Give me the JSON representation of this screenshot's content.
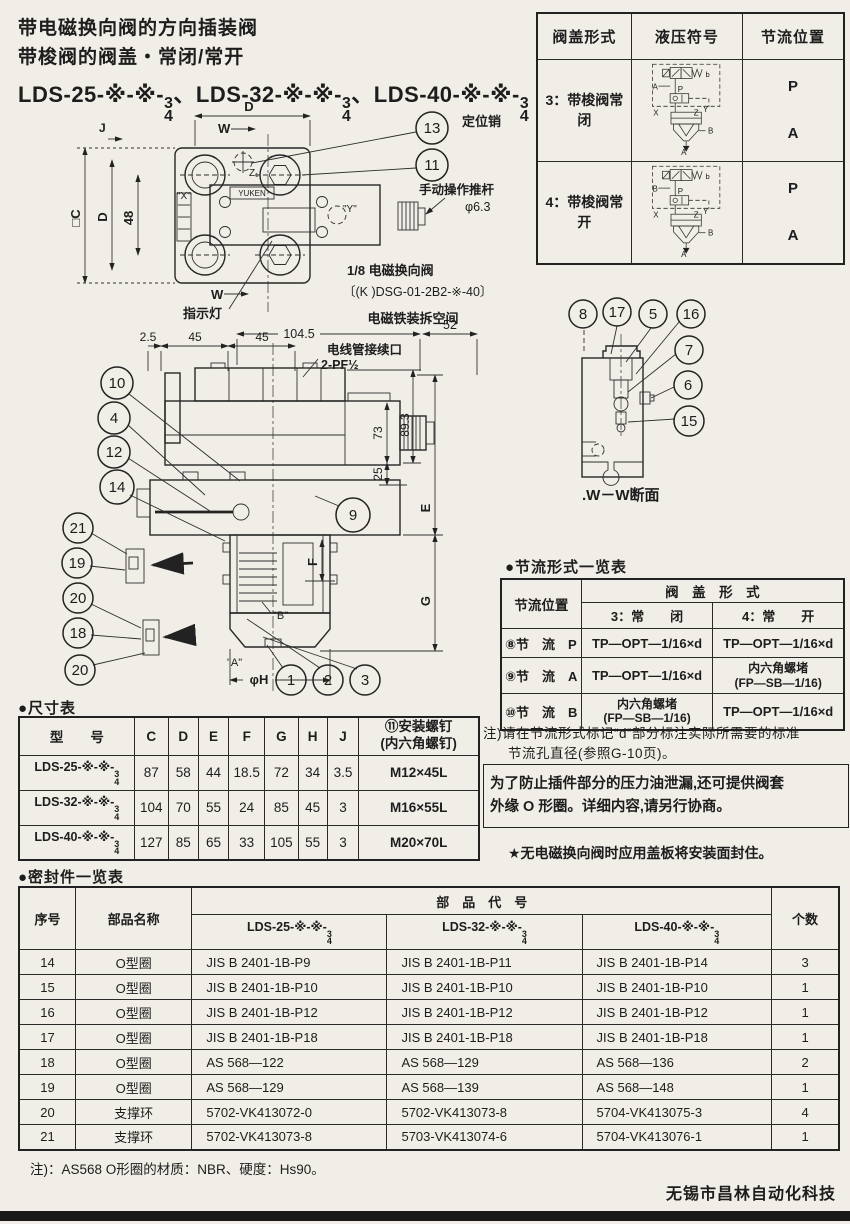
{
  "page": {
    "title_line1": "带电磁换向阀的方向插装阀",
    "title_line2": "带梭阀的阀盖・常闭/常开",
    "model_line": {
      "m1": "LDS-25-※-※-",
      "m2": "、LDS-32-※-※-",
      "m3": "、LDS-40-※-※-"
    },
    "frac": {
      "n": "3",
      "d": "4"
    },
    "footer": "无锡市昌林自动化科技"
  },
  "cover_table": {
    "h_form": "阀盖形式",
    "h_symbol": "液压符号",
    "h_throttle": "节流位置",
    "rows": [
      {
        "form": "3：带梭阀常闭",
        "p": "P",
        "a": "A",
        "sym": {
          "left": "A",
          "p": "P",
          "b": "b",
          "x": "X",
          "z": "Z",
          "y": "Y",
          "bport": "B",
          "abot": "A"
        }
      },
      {
        "form": "4：带梭阀常开",
        "p": "P",
        "a": "A",
        "sym": {
          "left": "B",
          "p": "P",
          "b": "b",
          "x": "X",
          "z": "Z",
          "y": "Y",
          "bport": "B",
          "abot": "A"
        }
      }
    ]
  },
  "top_view": {
    "balloon_13": "13",
    "balloon_11": "11",
    "pin_label": "定位销",
    "rod_label": "手动操作推杆",
    "rod_dia": "φ6.3",
    "sol_label1": "1/8 电磁换向阀",
    "sol_label2": "〔(K )DSG-01-2B2-※-40〕",
    "indicator": "指示灯",
    "dim_d_top": "D",
    "w1": "W",
    "w2": "W",
    "dim_j": "J",
    "dim_c": "□C",
    "dim_d_left": "D",
    "dim_48": "48",
    "port_x": "\"X\"",
    "port_y": "\"Y\"",
    "port_z": "Z₁",
    "brand": "YUKEN"
  },
  "section_view": {
    "removal_space": "电磁铁装拆空间",
    "dim_52": "52",
    "dim_104_5": "104.5",
    "dim_2_5": "2.5",
    "dim_45a": "45",
    "dim_45b": "45",
    "conduit1": "电线管接续口",
    "conduit2": "2-PF½",
    "dim_73": "73",
    "dim_89_3": "89.3",
    "dim_25": "25",
    "dim_e": "E",
    "dim_f": "F",
    "dim_g": "G",
    "dim_phi_h": "φH",
    "port_a": "\"A\"",
    "port_b": "\"B\"",
    "b10": "10",
    "b4": "4",
    "b12": "12",
    "b14": "14",
    "b21": "21",
    "b19": "19",
    "b20a": "20",
    "b18": "18",
    "b20b": "20",
    "b9": "9",
    "b1": "1",
    "b2": "2",
    "b3": "3"
  },
  "ww_view": {
    "caption": ".W－W断面",
    "b8": "8",
    "b17": "17",
    "b5": "5",
    "b16": "16",
    "b7": "7",
    "b6": "6",
    "b15": "15"
  },
  "throttle_table": {
    "title": "●节流形式一览表",
    "h_pos": "节流位置",
    "h_cover": "阀　盖　形　式",
    "h_closed": "3：常　　闭",
    "h_open": "4：常　　开",
    "rows": [
      {
        "pos": "⑧节　流　P",
        "closed1": "TP—OPT—1/16×d",
        "closed2": "",
        "open1": "TP—OPT—1/16×d",
        "open2": ""
      },
      {
        "pos": "⑨节　流　A",
        "closed1": "TP—OPT—1/16×d",
        "closed2": "",
        "open1": "内六角螺堵",
        "open2": "(FP—SB—1/16)"
      },
      {
        "pos": "⑩节　流　B",
        "closed1": "内六角螺堵",
        "closed2": "(FP—SB—1/16)",
        "open1": "TP—OPT—1/16×d",
        "open2": ""
      }
    ],
    "note1": "注)请在节流形式标记“d”部分标注实际所需要的标准",
    "note2": "节流孔直径(参照G-10页)。",
    "box1": "为了防止插件部分的压力油泄漏,还可提供阀套",
    "box2": "外缘 O 形圈。详细内容,请另行协商。",
    "star": "★无电磁换向阀时应用盖板将安装面封住。"
  },
  "dim_table": {
    "title": "●尺寸表",
    "h_model": "型　　号",
    "h_c": "C",
    "h_d": "D",
    "h_e": "E",
    "h_f": "F",
    "h_g": "G",
    "h_h": "H",
    "h_j": "J",
    "h_screw1": "⑪安装螺钉",
    "h_screw2": "(内六角螺钉)",
    "rows": [
      {
        "model": "LDS-25-※-※-",
        "c": "87",
        "d": "58",
        "e": "44",
        "f": "18.5",
        "g": "72",
        "h": "34",
        "j": "3.5",
        "screw": "M12×45L"
      },
      {
        "model": "LDS-32-※-※-",
        "c": "104",
        "d": "70",
        "e": "55",
        "f": "24",
        "g": "85",
        "h": "45",
        "j": "3",
        "screw": "M16×55L"
      },
      {
        "model": "LDS-40-※-※-",
        "c": "127",
        "d": "85",
        "e": "65",
        "f": "33",
        "g": "105",
        "h": "55",
        "j": "3",
        "screw": "M20×70L"
      }
    ]
  },
  "seal_table": {
    "title": "●密封件一览表",
    "h_no": "序号",
    "h_name": "部品名称",
    "h_code": "部　品　代　号",
    "h_qty": "个数",
    "m1": "LDS-25-※-※-",
    "m2": "LDS-32-※-※-",
    "m3": "LDS-40-※-※-",
    "rows": [
      {
        "no": "14",
        "name": "O型圈",
        "c1": "JIS B 2401-1B-P9",
        "c2": "JIS B 2401-1B-P11",
        "c3": "JIS B 2401-1B-P14",
        "qty": "3"
      },
      {
        "no": "15",
        "name": "O型圈",
        "c1": "JIS B 2401-1B-P10",
        "c2": "JIS B 2401-1B-P10",
        "c3": "JIS B 2401-1B-P10",
        "qty": "1"
      },
      {
        "no": "16",
        "name": "O型圈",
        "c1": "JIS B 2401-1B-P12",
        "c2": "JIS B 2401-1B-P12",
        "c3": "JIS B 2401-1B-P12",
        "qty": "1"
      },
      {
        "no": "17",
        "name": "O型圈",
        "c1": "JIS B 2401-1B-P18",
        "c2": "JIS B 2401-1B-P18",
        "c3": "JIS B 2401-1B-P18",
        "qty": "1"
      },
      {
        "no": "18",
        "name": "O型圈",
        "c1": "AS 568—122",
        "c2": "AS 568—129",
        "c3": "AS 568—136",
        "qty": "2"
      },
      {
        "no": "19",
        "name": "O型圈",
        "c1": "AS 568—129",
        "c2": "AS 568—139",
        "c3": "AS 568—148",
        "qty": "1"
      },
      {
        "no": "20",
        "name": "支撑环",
        "c1": "5702-VK413072-0",
        "c2": "5702-VK413073-8",
        "c3": "5704-VK413075-3",
        "qty": "4"
      },
      {
        "no": "21",
        "name": "支撑环",
        "c1": "5702-VK413073-8",
        "c2": "5703-VK413074-6",
        "c3": "5704-VK413076-1",
        "qty": "1"
      }
    ],
    "note": "注)：AS568 O形圈的材质：NBR、硬度：Hs90。"
  }
}
